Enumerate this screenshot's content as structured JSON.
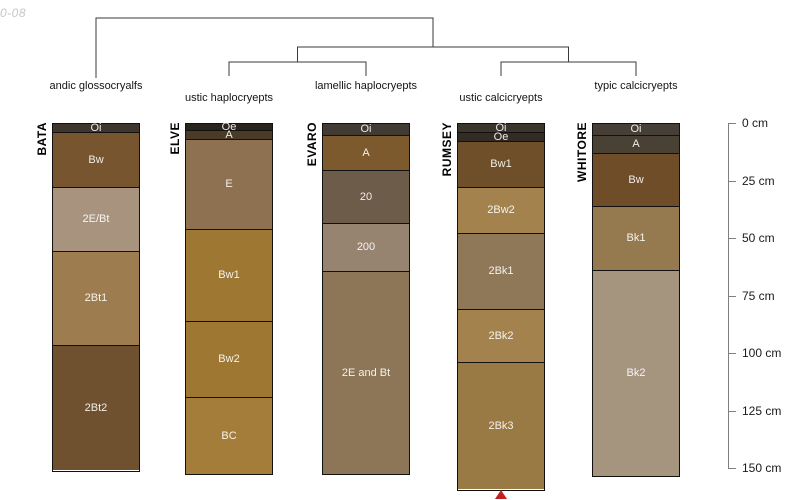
{
  "watermark": "0-08",
  "chart_data": {
    "type": "soil-profile-dendrogram",
    "description": "Dendrogram of soil taxonomy linking five pedon profile sketches with horizon depths in cm",
    "depth_axis": {
      "unit": "cm",
      "ticks": [
        0,
        25,
        50,
        75,
        100,
        125,
        150
      ],
      "labels": [
        "0 cm",
        "25 cm",
        "50 cm",
        "75 cm",
        "100 cm",
        "125 cm",
        "150 cm"
      ],
      "line_color": "#7f7f7f"
    },
    "dendrogram": {
      "line_color": "#3a3a3a",
      "structure": "(BATA,((ELVE,EVARO),(RUMSEY,WHITORE)))",
      "root_y": 18,
      "mid_y": 47,
      "sub_y": 62,
      "leaf_stub_y": 76,
      "first_leaf_stub_y": 78
    },
    "continuation_marker": {
      "shape": "triangle-up",
      "color": "#c41f1f"
    },
    "pedons": [
      {
        "id": "BATA",
        "taxon": "andic glossocryalfs",
        "taxon_row": 0,
        "truncated": false,
        "horizons": [
          {
            "name": "Oi",
            "top": 0,
            "bottom": 4,
            "color": "#3e362c"
          },
          {
            "name": "Bw",
            "top": 4,
            "bottom": 28,
            "color": "#77552f"
          },
          {
            "name": "2E/Bt",
            "top": 28,
            "bottom": 56,
            "color": "#a8937f"
          },
          {
            "name": "2Bt1",
            "top": 56,
            "bottom": 97,
            "color": "#9d7c50"
          },
          {
            "name": "2Bt2",
            "top": 97,
            "bottom": 151,
            "color": "#6f5130"
          }
        ]
      },
      {
        "id": "ELVE",
        "taxon": "ustic haplocryepts",
        "taxon_row": 1,
        "truncated": false,
        "horizons": [
          {
            "name": "Oe",
            "top": 0,
            "bottom": 3,
            "color": "#2b241c"
          },
          {
            "name": "A",
            "top": 3,
            "bottom": 7,
            "color": "#4a3b28"
          },
          {
            "name": "E",
            "top": 7,
            "bottom": 46,
            "color": "#8d7150"
          },
          {
            "name": "Bw1",
            "top": 46,
            "bottom": 86,
            "color": "#9e7833"
          },
          {
            "name": "Bw2",
            "top": 86,
            "bottom": 119,
            "color": "#9e7833"
          },
          {
            "name": "BC",
            "top": 119,
            "bottom": 152,
            "color": "#a57d3a"
          }
        ]
      },
      {
        "id": "EVARO",
        "taxon": "lamellic haplocryepts",
        "taxon_row": 0,
        "truncated": false,
        "horizons": [
          {
            "name": "Oi",
            "top": 0,
            "bottom": 5,
            "color": "#423b33"
          },
          {
            "name": "A",
            "top": 5,
            "bottom": 20,
            "color": "#7d5a2e"
          },
          {
            "name": "20",
            "top": 20,
            "bottom": 43,
            "color": "#6d5c49"
          },
          {
            "name": "200",
            "top": 43,
            "bottom": 64,
            "color": "#968471"
          },
          {
            "name": "2E and Bt",
            "top": 64,
            "bottom": 152,
            "color": "#8d7557"
          }
        ]
      },
      {
        "id": "RUMSEY",
        "taxon": "ustic calcicryepts",
        "taxon_row": 1,
        "truncated": true,
        "horizons": [
          {
            "name": "Oi",
            "top": 0,
            "bottom": 4,
            "color": "#3b352c"
          },
          {
            "name": "Oe",
            "top": 4,
            "bottom": 8,
            "color": "#332c24"
          },
          {
            "name": "Bw1",
            "top": 8,
            "bottom": 28,
            "color": "#6f4e2a"
          },
          {
            "name": "2Bw2",
            "top": 28,
            "bottom": 48,
            "color": "#a3824e"
          },
          {
            "name": "2Bk1",
            "top": 48,
            "bottom": 81,
            "color": "#8e7857"
          },
          {
            "name": "2Bk2",
            "top": 81,
            "bottom": 104,
            "color": "#a3824e"
          },
          {
            "name": "2Bk3",
            "top": 104,
            "bottom": 159,
            "color": "#9a7a44"
          }
        ]
      },
      {
        "id": "WHITORE",
        "taxon": "typic calcicryepts",
        "taxon_row": 0,
        "truncated": false,
        "horizons": [
          {
            "name": "Oi",
            "top": 0,
            "bottom": 5,
            "color": "#453f37"
          },
          {
            "name": "A",
            "top": 5,
            "bottom": 13,
            "color": "#4a4135"
          },
          {
            "name": "Bw",
            "top": 13,
            "bottom": 36,
            "color": "#6e4d28"
          },
          {
            "name": "Bk1",
            "top": 36,
            "bottom": 64,
            "color": "#957a50"
          },
          {
            "name": "Bk2",
            "top": 64,
            "bottom": 153,
            "color": "#a5947e"
          }
        ]
      }
    ]
  }
}
